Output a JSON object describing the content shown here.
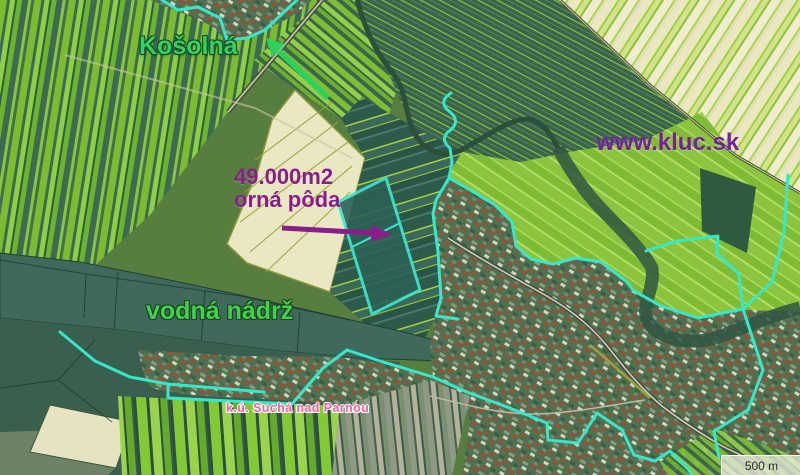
{
  "map": {
    "labels": {
      "village": "Košolná",
      "area_line1": "49.000m2",
      "area_line2": "orná pôda",
      "website": "www.kluc.sk",
      "water": "vodná nádrž",
      "cadastre": "k.ú. Suchá nad Parnou"
    },
    "scale": {
      "label": "500 m"
    },
    "colors": {
      "village_label": "#2fd45e",
      "water_label": "#3fd34a",
      "area_label": "#8b1d8b",
      "website_label": "#7520a0",
      "cadastre_label": "#ff5f9e",
      "cadastral_boundary": "#35e8cb",
      "highlight_parcel_stroke": "#3be8d2",
      "water_fill": "#3e695b",
      "green_arrow": "#2ed05c",
      "purple_arrow": "#8b1d8b"
    }
  }
}
